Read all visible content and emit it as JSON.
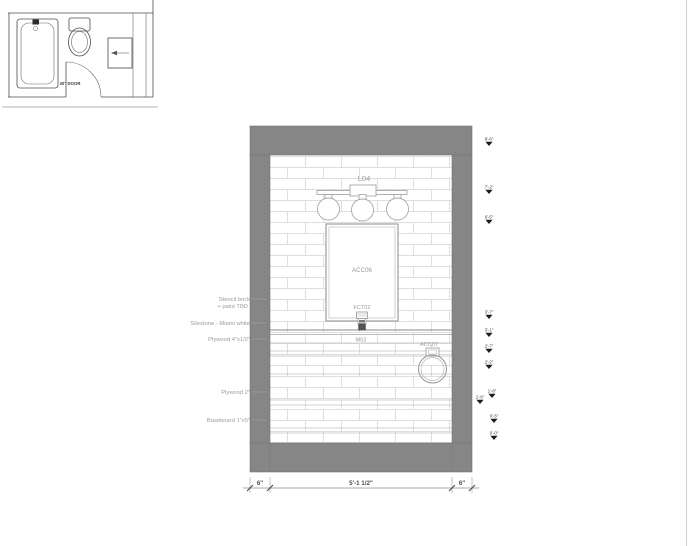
{
  "plan": {
    "door_label": "30\" DOOR"
  },
  "elevation": {
    "light_label": "L04",
    "mirror_label": "ACC06",
    "faucet_label": "FCT02",
    "vanity_label": "M02",
    "towel_ring_label": "ACC07"
  },
  "notes": {
    "stencil_line1": "Stencil brick",
    "stencil_line2": "+  paint TBD",
    "silestone": "Silestone -  Miami white",
    "plywood_thin": "Plywood  4\"x1/2\"",
    "plywood_thick": "Plywood  2\"",
    "baseboard": "Baseboard  1\"x5\""
  },
  "dimensions": {
    "left": "6\"",
    "center": "5'-1 1/2\"",
    "right": "6\""
  },
  "markers": [
    {
      "label": "8'-6\""
    },
    {
      "label": "7'-2\""
    },
    {
      "label": "6'-5\""
    },
    {
      "label": "3'-7\""
    },
    {
      "label": "3'-1\""
    },
    {
      "label": "2'-7\""
    },
    {
      "label": "2'-2\""
    },
    {
      "label": "1'-8\""
    },
    {
      "label": "1'-6\""
    },
    {
      "label": "0'-5\""
    },
    {
      "label": "0'-0\""
    }
  ],
  "colors": {
    "wall_gray": "#868686",
    "tile_line": "#dedede"
  }
}
